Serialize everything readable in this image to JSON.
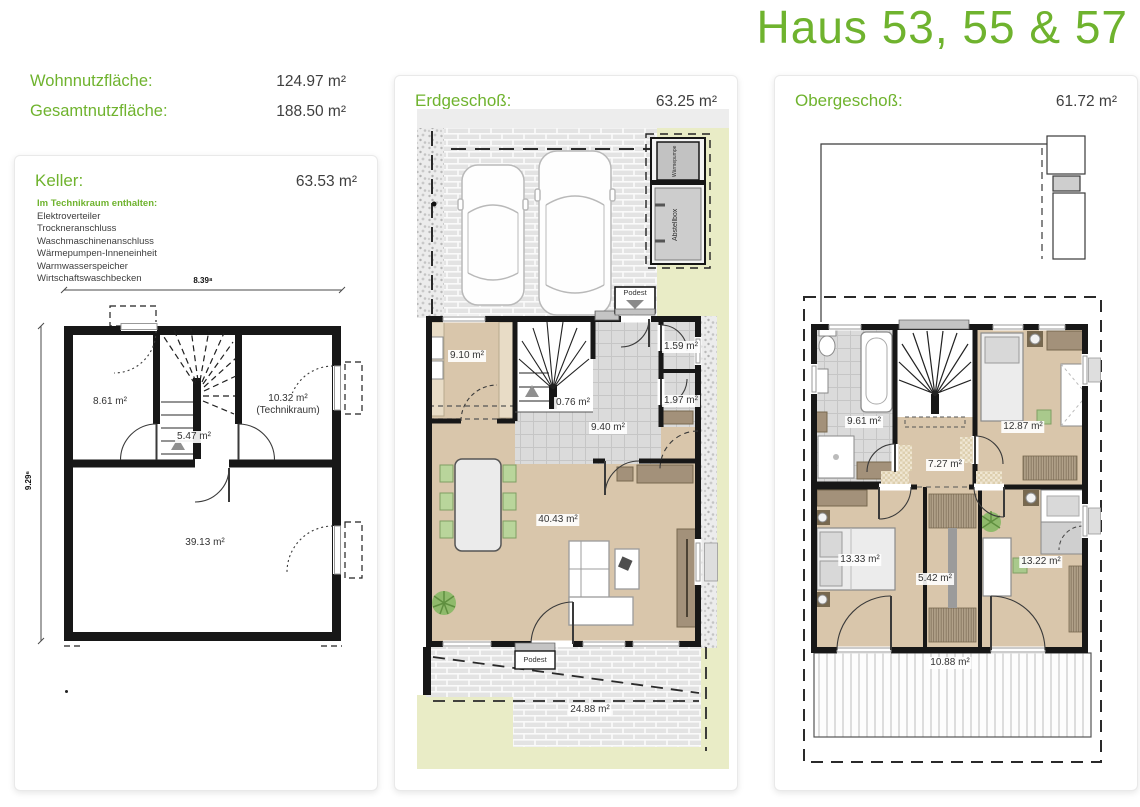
{
  "page": {
    "title": "Haus 53, 55 & 57"
  },
  "summary": {
    "wohnnutzflaeche_label": "Wohnnutzfläche:",
    "wohnnutzflaeche_value": "124.97 m²",
    "gesamtnutzflaeche_label": "Gesamtnutzfläche:",
    "gesamtnutzflaeche_value": "188.50 m²"
  },
  "keller": {
    "title": "Keller:",
    "area": "63.53 m²",
    "note_title": "Im Technikraum enthalten:",
    "note_items": [
      "Elektroverteiler",
      "Trockneranschluss",
      "Waschmaschinenanschluss",
      "Wärmepumpen-Inneneinheit",
      "Warmwasserspeicher",
      "Wirtschaftswaschbecken"
    ],
    "dim_width": "8.39⁸",
    "dim_height": "9.29⁶",
    "rooms": {
      "hobbyraum": "8.61 m²",
      "flur": "5.47 m²",
      "technikraum": "10.32 m²",
      "technikraum_name": "(Technikraum)",
      "keller_raum": "39.13 m²"
    }
  },
  "erdgeschoss": {
    "title": "Erdgeschoß:",
    "area": "63.25 m²",
    "labels": {
      "waermepumpe": "Wärmepumpe",
      "abstellbox": "Abstellbox",
      "podest_entry": "Podest",
      "podest_terrace": "Podest"
    },
    "rooms": {
      "kueche": "9.10 m²",
      "abstellraum_treppe": "0.76 m²",
      "diele": "9.40 m²",
      "wc": "1.59 m²",
      "abstellraum": "1.97 m²",
      "wohnen_essen": "40.43 m²",
      "terrasse": "24.88 m²"
    }
  },
  "obergeschoss": {
    "title": "Obergeschoß:",
    "area": "61.72 m²",
    "rooms": {
      "bad": "9.61 m²",
      "flur": "7.27 m²",
      "zimmer1": "12.87 m²",
      "schlafzimmer": "13.33 m²",
      "ankleide": "5.42 m²",
      "zimmer2": "13.22 m²",
      "balkon": "10.88 m²"
    }
  }
}
